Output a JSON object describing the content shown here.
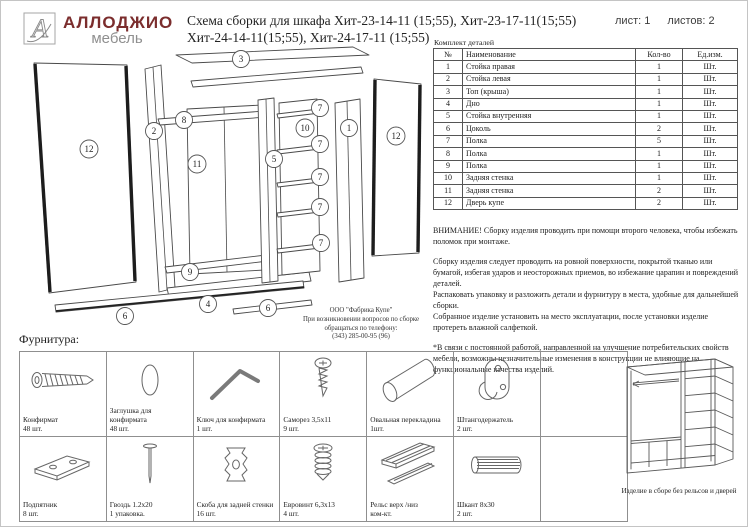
{
  "header": {
    "logo_mark": "А",
    "brand": "АЛЛОДЖИО",
    "brand_sub": "мебель",
    "title_line1": "Схема сборки для шкафа Хит-23-14-11 (15;55), Хит-23-17-11(15;55)",
    "title_line2": "Хит-24-14-11(15;55), Хит-24-17-11 (15;55)",
    "sheet_label": "лист: 1",
    "sheets_label": "листов: 2"
  },
  "parts_table": {
    "caption": "Комплект деталей",
    "columns": [
      "№",
      "Наименование",
      "Кол-во",
      "Ед.изм."
    ],
    "rows": [
      [
        "1",
        "Стойка правая",
        "1",
        "Шт."
      ],
      [
        "2",
        "Стойка левая",
        "1",
        "Шт."
      ],
      [
        "3",
        "Топ (крыша)",
        "1",
        "Шт."
      ],
      [
        "4",
        "Дно",
        "1",
        "Шт."
      ],
      [
        "5",
        "Стойка внутренняя",
        "1",
        "Шт."
      ],
      [
        "6",
        "Цоколь",
        "2",
        "Шт."
      ],
      [
        "7",
        "Полка",
        "5",
        "Шт."
      ],
      [
        "8",
        "Полка",
        "1",
        "Шт."
      ],
      [
        "9",
        "Полка",
        "1",
        "Шт."
      ],
      [
        "10",
        "Задняя стенка",
        "1",
        "Шт."
      ],
      [
        "11",
        "Задняя стенка",
        "2",
        "Шт."
      ],
      [
        "12",
        "Дверь купе",
        "2",
        "Шт."
      ]
    ]
  },
  "notices": {
    "warning": "ВНИМАНИЕ! Сборку изделия проводить при помощи второго человека, чтобы избежать поломок при монтаже.",
    "p1": "Сборку изделия следует проводить на ровной поверхности, покрытой тканью или бумагой, избегая ударов и неосторожных приемов, во избежание царапин и повреждений деталей.",
    "p2": "Распаковать упаковку и разложить детали и фурнитуру в места, удобные для дальнейшей сборки.",
    "p3": "Собранное изделие установить на место эксплуатации, после установки изделие протереть влажной салфеткой.",
    "p4": "*В связи с постоянной работой, направленной на улучшение потребительских свойств мебели, возможны незначительные изменения в конструкции не влияющие на функциональные качества изделий."
  },
  "manufacturer": {
    "line1": "ООО \"Фабрика Купе\"",
    "line2": "При возникновении вопросов  по сборке",
    "line3": "обращаться по телефону:",
    "line4": "(343) 285-00-95 (96)"
  },
  "diagram": {
    "callouts": [
      "3",
      "12",
      "2",
      "8",
      "11",
      "9",
      "4",
      "6",
      "6",
      "5",
      "10",
      "1",
      "7",
      "7",
      "7",
      "7",
      "7",
      "12"
    ]
  },
  "hardware": {
    "section_title": "Фурнитура:",
    "items": [
      {
        "name": "Конфирмат",
        "qty": "48 шт.",
        "icon": "confirmat-screw"
      },
      {
        "name": "Заглушка для конфирмата",
        "qty": "48 шт.",
        "icon": "confirmat-cap"
      },
      {
        "name": "Ключ для конфирмата",
        "qty": "1 шт.",
        "icon": "hex-key"
      },
      {
        "name": "Саморез 3,5х11",
        "qty": "9 шт.",
        "icon": "small-screw"
      },
      {
        "name": "Овальная перекладина",
        "qty": "1шт.",
        "icon": "oval-rod"
      },
      {
        "name": "Штангодержатель",
        "qty": "2 шт.",
        "icon": "rod-holder"
      },
      {
        "name": "Подпятник",
        "qty": "8 шт.",
        "icon": "foot-plate"
      },
      {
        "name": "Гвоздь 1.2х20",
        "qty": "1 упаковка.",
        "icon": "nail"
      },
      {
        "name": "Скоба для задней стенки",
        "qty": "16 шт.",
        "icon": "back-wall-clip"
      },
      {
        "name": "Евровинт 6,3х13",
        "qty": "4 шт.",
        "icon": "euro-screw"
      },
      {
        "name": "Рельс верх /низ",
        "qty": "ком-кт.",
        "icon": "rails"
      },
      {
        "name": "Шкант 8х30",
        "qty": "2 шт.",
        "icon": "dowel"
      }
    ]
  },
  "assembled": {
    "caption": "Изделие в сборе без рельсов и дверей"
  },
  "colors": {
    "brand": "#7b2d2d",
    "muted": "#8f8f8f"
  }
}
